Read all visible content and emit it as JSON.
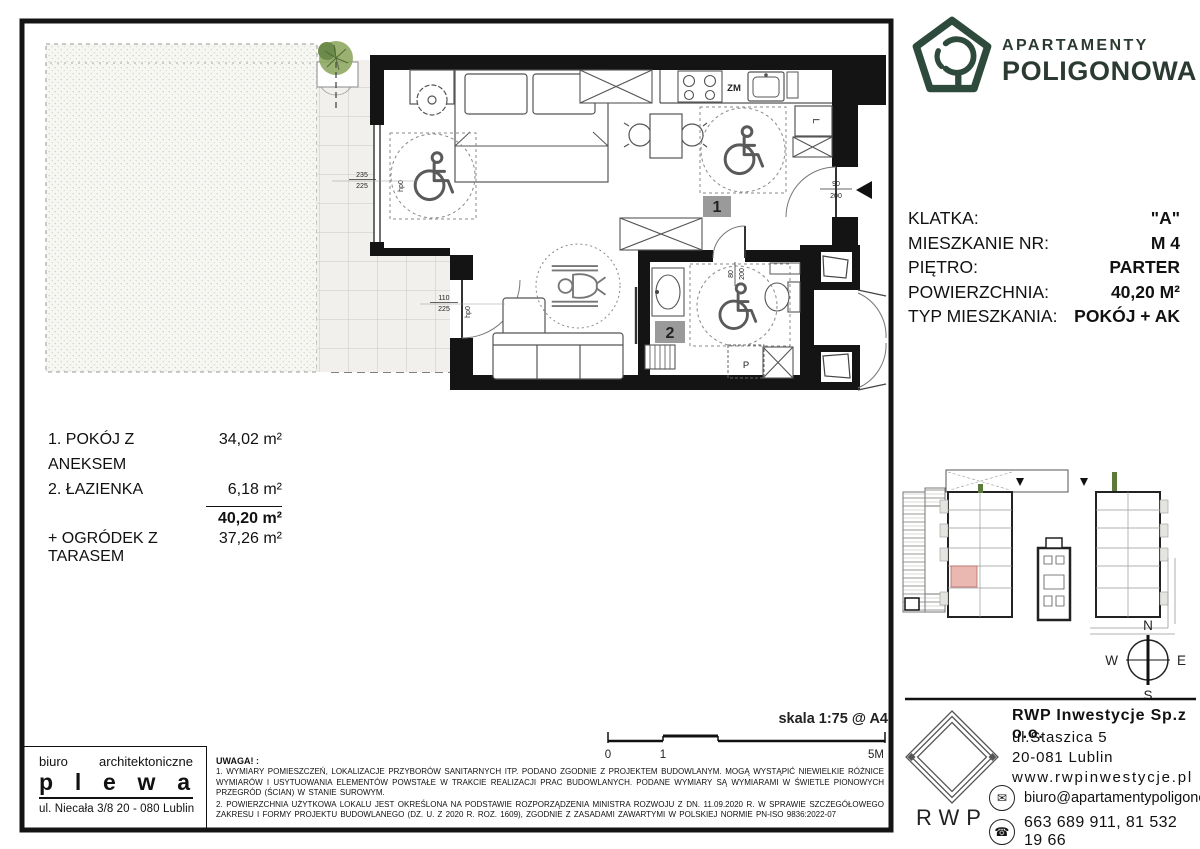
{
  "brand": {
    "line1": "APARTAMENTY",
    "line2": "POLIGONOWA",
    "color": "#2c3b32"
  },
  "info": {
    "rows": [
      {
        "label": "KLATKA:",
        "value": "\"A\""
      },
      {
        "label": "MIESZKANIE NR:",
        "value": "M 4"
      },
      {
        "label": "PIĘTRO:",
        "value": "PARTER"
      },
      {
        "label": "POWIERZCHNIA:",
        "value": "40,20 M²"
      },
      {
        "label": "TYP MIESZKANIA:",
        "value": "POKÓJ + AK"
      }
    ]
  },
  "rooms": {
    "items": [
      {
        "num_name": "1. POKÓJ Z ANEKSEM",
        "area": "34,02 m²"
      },
      {
        "num_name": "2. ŁAZIENKA",
        "area": "6,18 m²"
      }
    ],
    "total": "40,20 m²",
    "garden_label": "+ OGRÓDEK Z TARASEM",
    "garden_area": "37,26 m²"
  },
  "plan": {
    "room1": "1",
    "room2": "2",
    "zm": "ZM",
    "fridge": "L",
    "shower": "P",
    "hp1": "hp0",
    "hp2": "hp0",
    "dims": {
      "window": {
        "top": "235",
        "bottom": "225"
      },
      "balcony": {
        "top": "110",
        "bottom": "225"
      },
      "entrance": {
        "top": "90",
        "bottom": "200"
      },
      "bath": {
        "top": "80",
        "bottom": "200"
      }
    }
  },
  "scale": {
    "title": "skala 1:75 @ A4",
    "t0": "0",
    "t1": "1",
    "t2": "5M"
  },
  "compass": {
    "n": "N",
    "e": "E",
    "s": "S",
    "w": "W"
  },
  "architect": {
    "line1": "biuro architektoniczne",
    "name": "p l e w a",
    "address": "ul. Niecała 3/8  20 - 080 Lublin"
  },
  "notes": {
    "header": "UWAGA! :",
    "p1": "1. WYMIARY POMIESZCZEŃ, LOKALIZACJE PRZYBORÓW SANITARNYCH ITP. PODANO ZGODNIE Z PROJEKTEM BUDOWLANYM. MOGĄ WYSTĄPIĆ NIEWIELKIE RÓŻNICE WYMIARÓW I USYTUOWANIA ELEMENTÓW POWSTAŁE W TRAKCIE REALIZACJI PRAC BUDOWLANYCH. PODANE WYMIARY SĄ WYMIARAMI W ŚWIETLE PIONOWYCH PRZEGRÓD (ŚCIAN) W STANIE SUROWYM.",
    "p2": "2. POWIERZCHNIA UŻYTKOWA LOKALU JEST OKREŚLONA NA PODSTAWIE ROZPORZĄDZENIA MINISTRA ROZWOJU Z DN. 11.09.2020 R. W SPRAWIE SZCZEGÓŁOWEGO ZAKRESU I FORMY PROJEKTU BUDOWLANEGO (DZ. U. Z 2020 R. ROZ. 1609), ZGODNIE Z ZASADAMI ZAWARTYMI W POLSKIEJ NORMIE PN-ISO 9836:2022-07"
  },
  "developer": {
    "logo_text": "RWP",
    "company": "RWP Inwestycje Sp.z o.o.",
    "address1": "ul.Staszica 5",
    "address2": "20-081 Lublin",
    "website": "www.rwpinwestycje.pl",
    "email": "biuro@apartamentypoligonowa.pl",
    "phones": "663 689 911,  81 532 19 66"
  },
  "colors": {
    "accent_green": "#2c3b32",
    "unit_highlight": "#eab7b1",
    "label_gray": "#9a9a9a"
  }
}
